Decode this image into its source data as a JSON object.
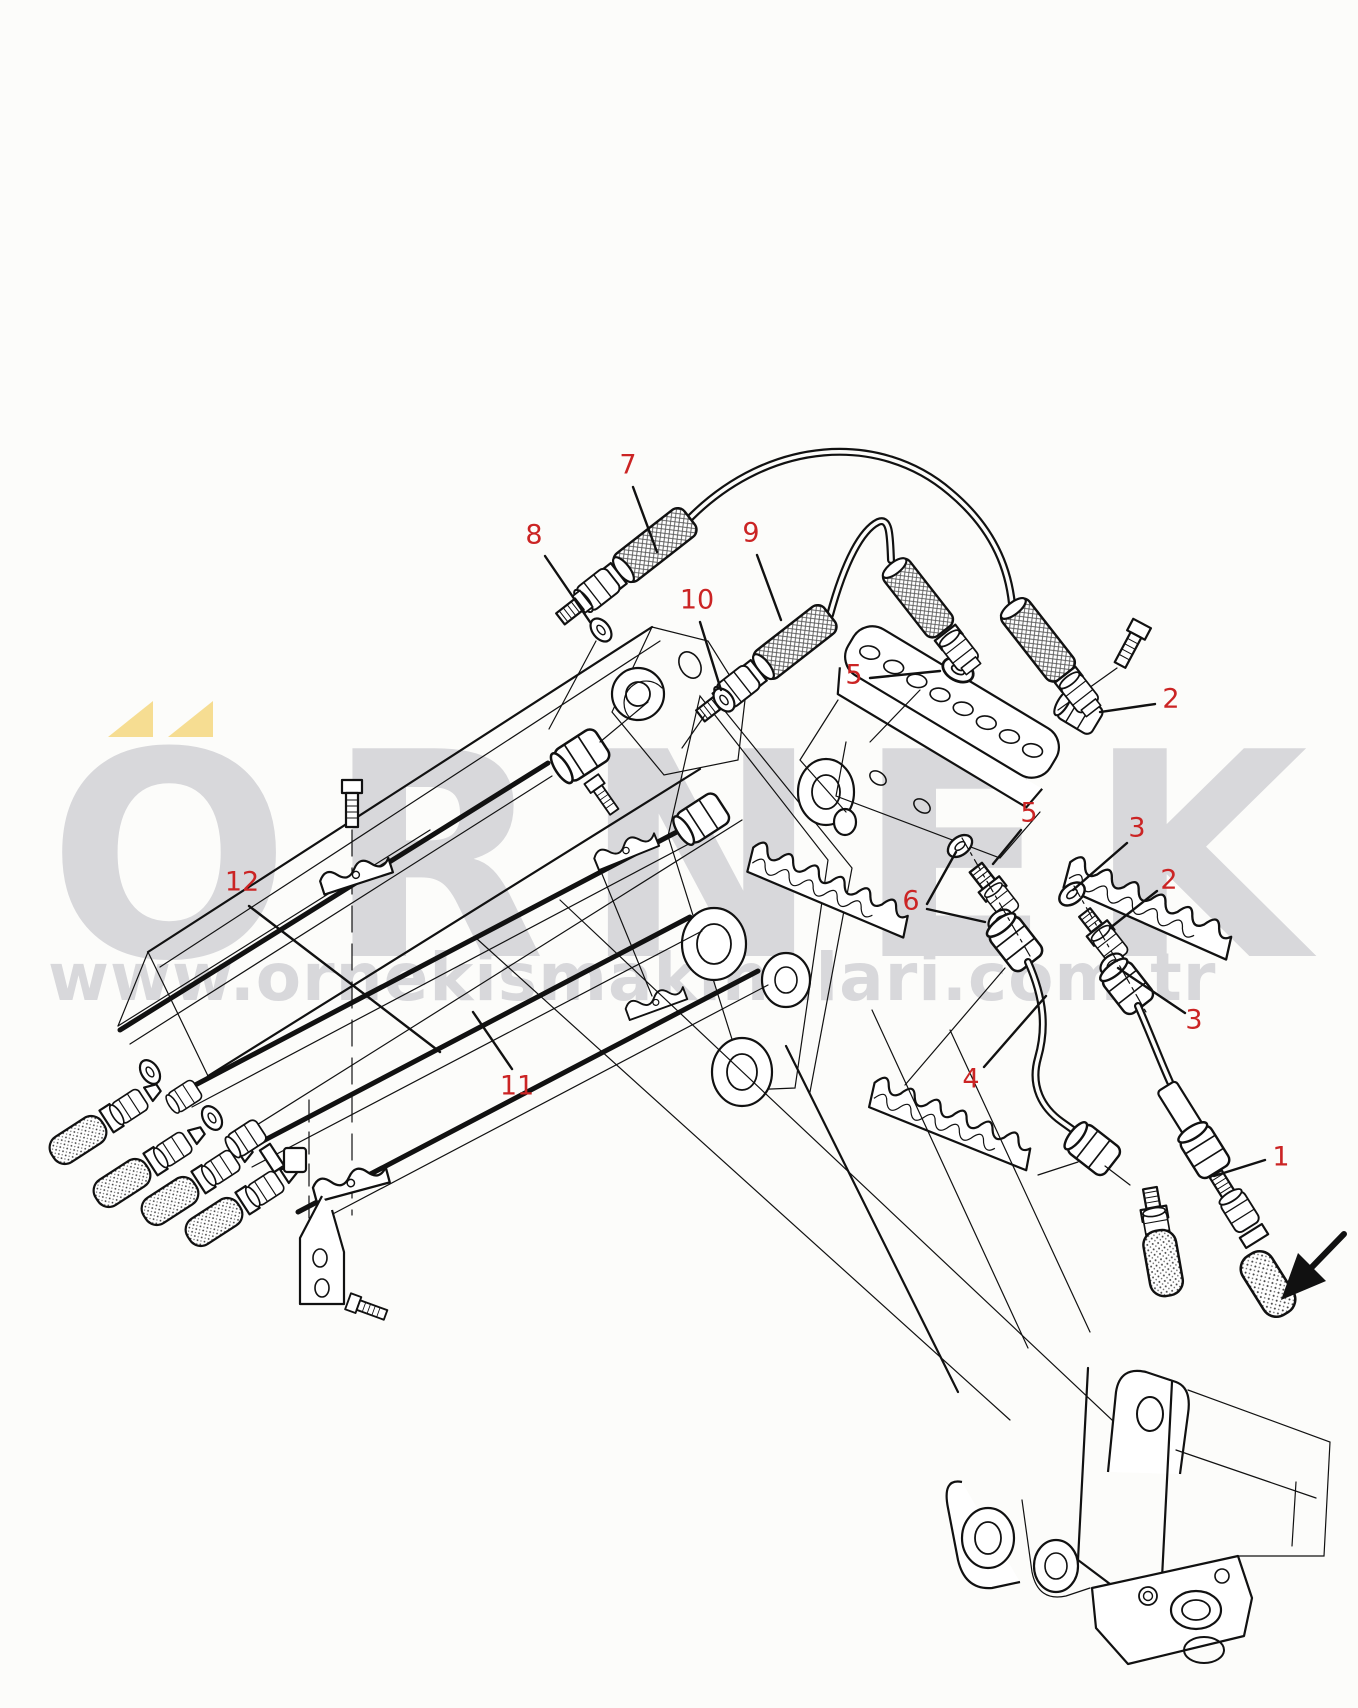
{
  "page": {
    "width": 1358,
    "height": 1708,
    "background": "#fcfcfa"
  },
  "colors": {
    "line": "#111111",
    "callout_red": "#cb2424",
    "watermark_gray": "#d8d8db",
    "accent_yellow": "#f6dd92"
  },
  "watermark": {
    "brand_text": "ÖRNEK",
    "brand_text_base": "ORNEK",
    "url_text": "www.ornekismakinalari.com.tr"
  },
  "callouts": [
    {
      "label": "7",
      "x": 628,
      "y": 465,
      "leaders": [
        [
          633,
          487,
          657,
          552
        ]
      ]
    },
    {
      "label": "8",
      "x": 534,
      "y": 535,
      "leaders": [
        [
          545,
          556,
          590,
          622
        ]
      ]
    },
    {
      "label": "9",
      "x": 751,
      "y": 533,
      "leaders": [
        [
          757,
          555,
          781,
          620
        ]
      ]
    },
    {
      "label": "10",
      "x": 697,
      "y": 600,
      "leaders": [
        [
          700,
          622,
          721,
          690
        ]
      ]
    },
    {
      "label": "5",
      "x": 854,
      "y": 675,
      "leaders": [
        [
          870,
          678,
          940,
          671
        ]
      ]
    },
    {
      "label": "2",
      "x": 1171,
      "y": 699,
      "leaders": [
        [
          1155,
          704,
          1100,
          712
        ]
      ]
    },
    {
      "label": "5",
      "x": 1029,
      "y": 813,
      "leaders": [
        [
          1021,
          830,
          993,
          864
        ]
      ]
    },
    {
      "label": "3",
      "x": 1137,
      "y": 828,
      "leaders": [
        [
          1127,
          843,
          1073,
          890
        ]
      ]
    },
    {
      "label": "6",
      "x": 911,
      "y": 901,
      "leaders": [
        [
          927,
          904,
          956,
          852
        ],
        [
          927,
          909,
          985,
          922
        ]
      ]
    },
    {
      "label": "2",
      "x": 1169,
      "y": 880,
      "leaders": [
        [
          1157,
          891,
          1110,
          928
        ]
      ]
    },
    {
      "label": "3",
      "x": 1194,
      "y": 1020,
      "leaders": [
        [
          1185,
          1013,
          1118,
          968
        ]
      ]
    },
    {
      "label": "12",
      "x": 242,
      "y": 882,
      "leaders": [
        [
          249,
          906,
          440,
          1052
        ]
      ]
    },
    {
      "label": "11",
      "x": 517,
      "y": 1086,
      "leaders": [
        [
          512,
          1069,
          473,
          1012
        ]
      ]
    },
    {
      "label": "4",
      "x": 971,
      "y": 1079,
      "leaders": [
        [
          984,
          1067,
          1046,
          996
        ]
      ]
    },
    {
      "label": "1",
      "x": 1281,
      "y": 1157,
      "leaders": [
        [
          1265,
          1160,
          1214,
          1176
        ]
      ]
    }
  ]
}
